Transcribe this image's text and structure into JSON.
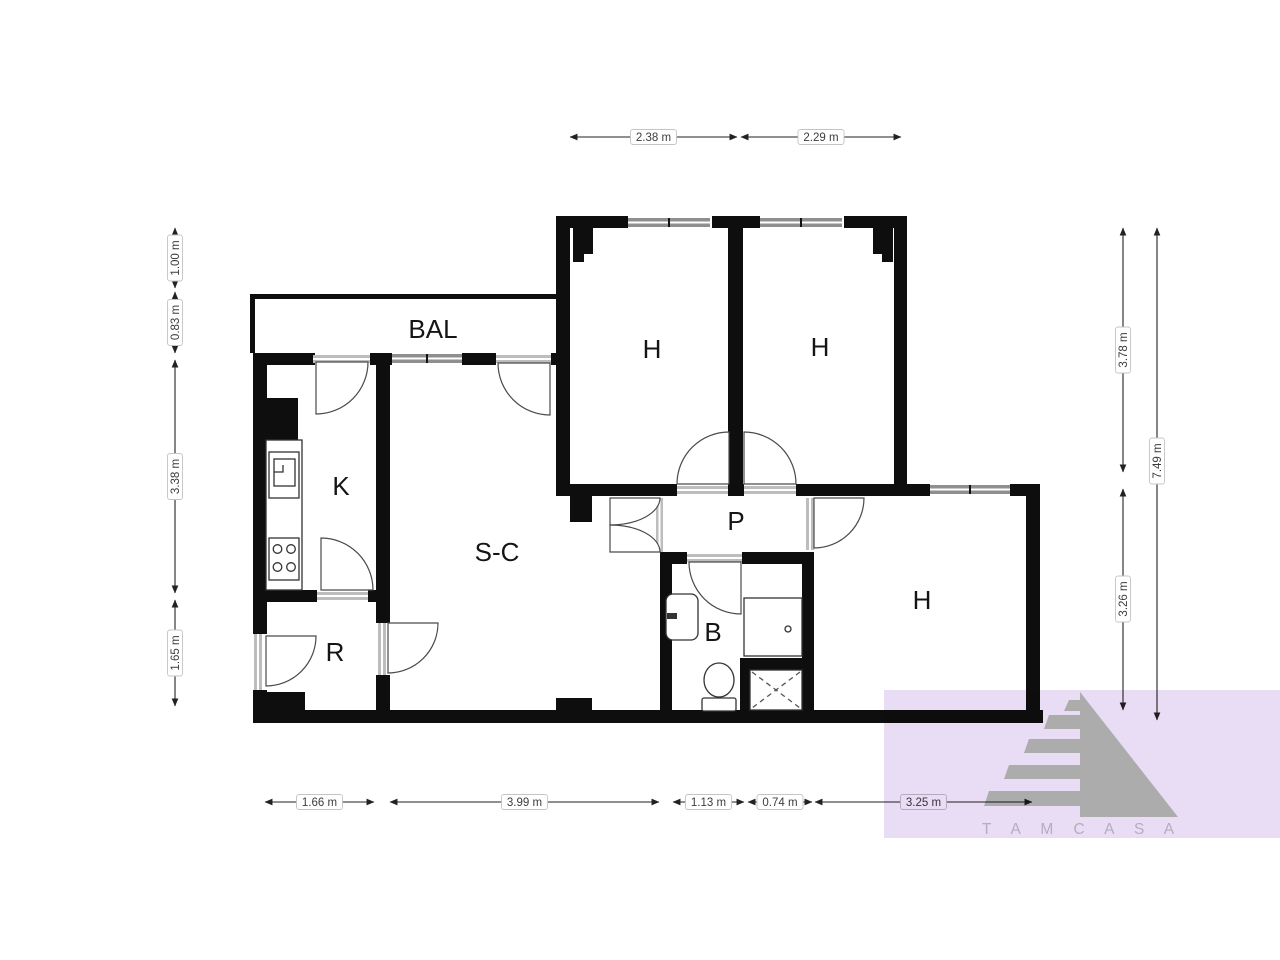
{
  "plan": {
    "rooms": [
      {
        "key": "bal",
        "label": "BAL"
      },
      {
        "key": "h1",
        "label": "H"
      },
      {
        "key": "h2",
        "label": "H"
      },
      {
        "key": "k",
        "label": "K"
      },
      {
        "key": "sc",
        "label": "S-C"
      },
      {
        "key": "p",
        "label": "P"
      },
      {
        "key": "b",
        "label": "B"
      },
      {
        "key": "r",
        "label": "R"
      },
      {
        "key": "h3",
        "label": "H"
      }
    ],
    "dimensions": {
      "top": [
        {
          "label": "2.38 m"
        },
        {
          "label": "2.29 m"
        }
      ],
      "left": [
        {
          "label": "1.00 m"
        },
        {
          "label": "0.83 m"
        },
        {
          "label": "3.38 m"
        },
        {
          "label": "1.65 m"
        }
      ],
      "right": [
        {
          "label": "3.78 m"
        },
        {
          "label": "3.26 m"
        },
        {
          "label": "7.49 m"
        }
      ],
      "bottom": [
        {
          "label": "1.66 m"
        },
        {
          "label": "3.99 m"
        },
        {
          "label": "1.13 m"
        },
        {
          "label": "0.74 m"
        },
        {
          "label": "3.25 m"
        }
      ]
    }
  },
  "watermark": {
    "text": "T A M C A S A"
  },
  "colors": {
    "wall": "#0e0e0e",
    "window_band": "#8f8f8f",
    "door_band": "#bdbdbd",
    "dim_text": "#3c3c3c",
    "watermark_bg": "#e9dcf5",
    "watermark_logo": "#acacac",
    "watermark_text": "#b3aebc"
  }
}
